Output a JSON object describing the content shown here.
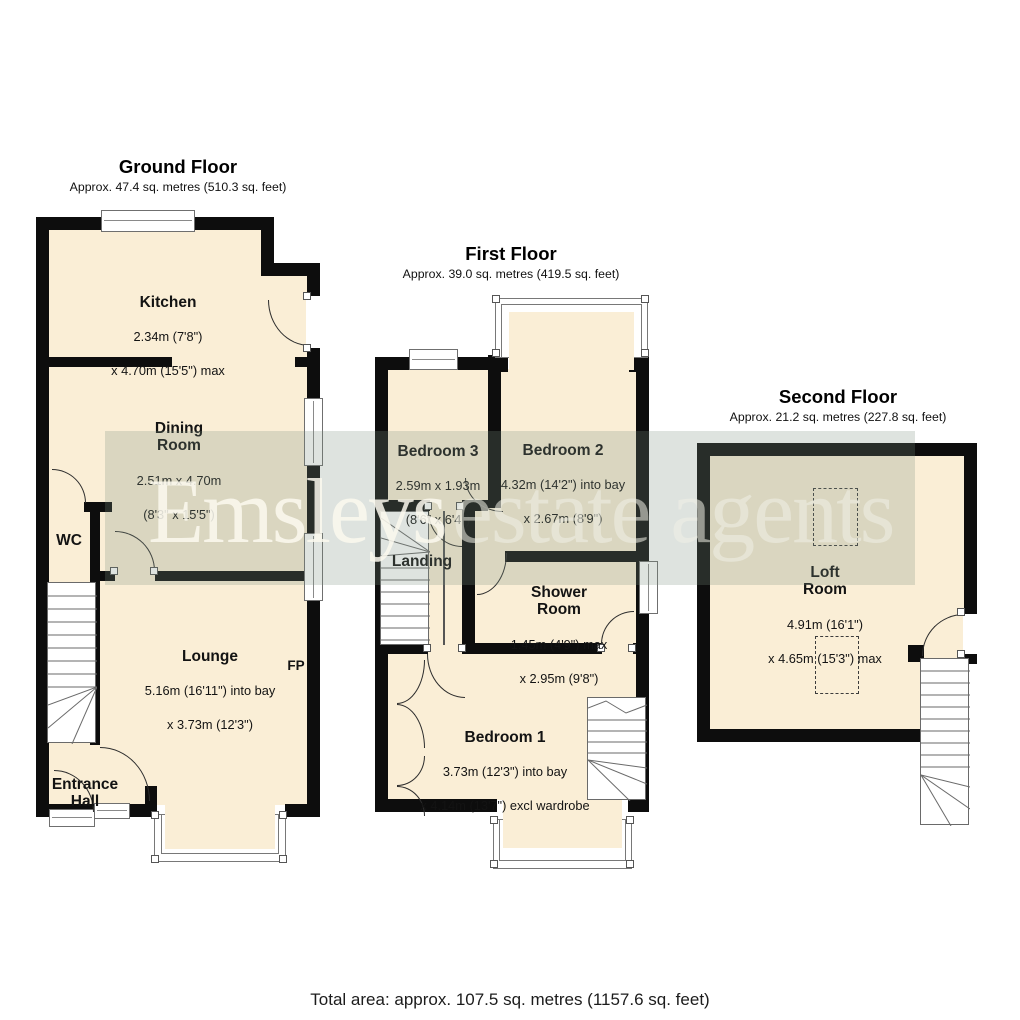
{
  "watermark": {
    "brand": "Emsleys",
    "suffix": "estate agents"
  },
  "footer": {
    "total_area": "Total area: approx. 107.5 sq. metres (1157.6 sq. feet)"
  },
  "floors": [
    {
      "title": "Ground Floor",
      "subtitle": "Approx. 47.4 sq. metres (510.3 sq. feet)",
      "rooms": [
        {
          "name": "Kitchen",
          "dims": [
            "2.34m (7'8\")",
            "x 4.70m (15'5\") max"
          ]
        },
        {
          "name": "Dining\nRoom",
          "dims": [
            "2.51m x 4.70m",
            "(8'3\" x 15'5\")"
          ]
        },
        {
          "name": "WC",
          "dims": []
        },
        {
          "name": "Lounge",
          "dims": [
            "5.16m (16'11\") into bay",
            "x 3.73m (12'3\")"
          ]
        },
        {
          "name": "Entrance\nHall",
          "dims": []
        }
      ],
      "annotations": [
        {
          "label": "FP"
        }
      ]
    },
    {
      "title": "First Floor",
      "subtitle": "Approx. 39.0 sq. metres (419.5 sq. feet)",
      "rooms": [
        {
          "name": "Bedroom 3",
          "dims": [
            "2.59m x 1.93m",
            "(8'6\" x 6'4\")"
          ]
        },
        {
          "name": "Bedroom 2",
          "dims": [
            "4.32m (14'2\") into bay",
            "x 2.67m (8'9\")"
          ]
        },
        {
          "name": "Landing",
          "dims": []
        },
        {
          "name": "Shower\nRoom",
          "dims": [
            "1.45m (4'9\") max",
            "x 2.95m (9'8\")"
          ]
        },
        {
          "name": "Bedroom 1",
          "dims": [
            "3.73m (12'3\") into bay",
            "x 4.14m (13'7\") excl wardrobe"
          ]
        }
      ]
    },
    {
      "title": "Second Floor",
      "subtitle": "Approx. 21.2 sq. metres (227.8 sq. feet)",
      "rooms": [
        {
          "name": "Loft\nRoom",
          "dims": [
            "4.91m (16'1\")",
            "x 4.65m (15'3\") max"
          ]
        }
      ]
    }
  ],
  "colors": {
    "room_fill": "#faeed6",
    "wall": "#0d0d0d",
    "window_frame": "#6f6f6f"
  }
}
